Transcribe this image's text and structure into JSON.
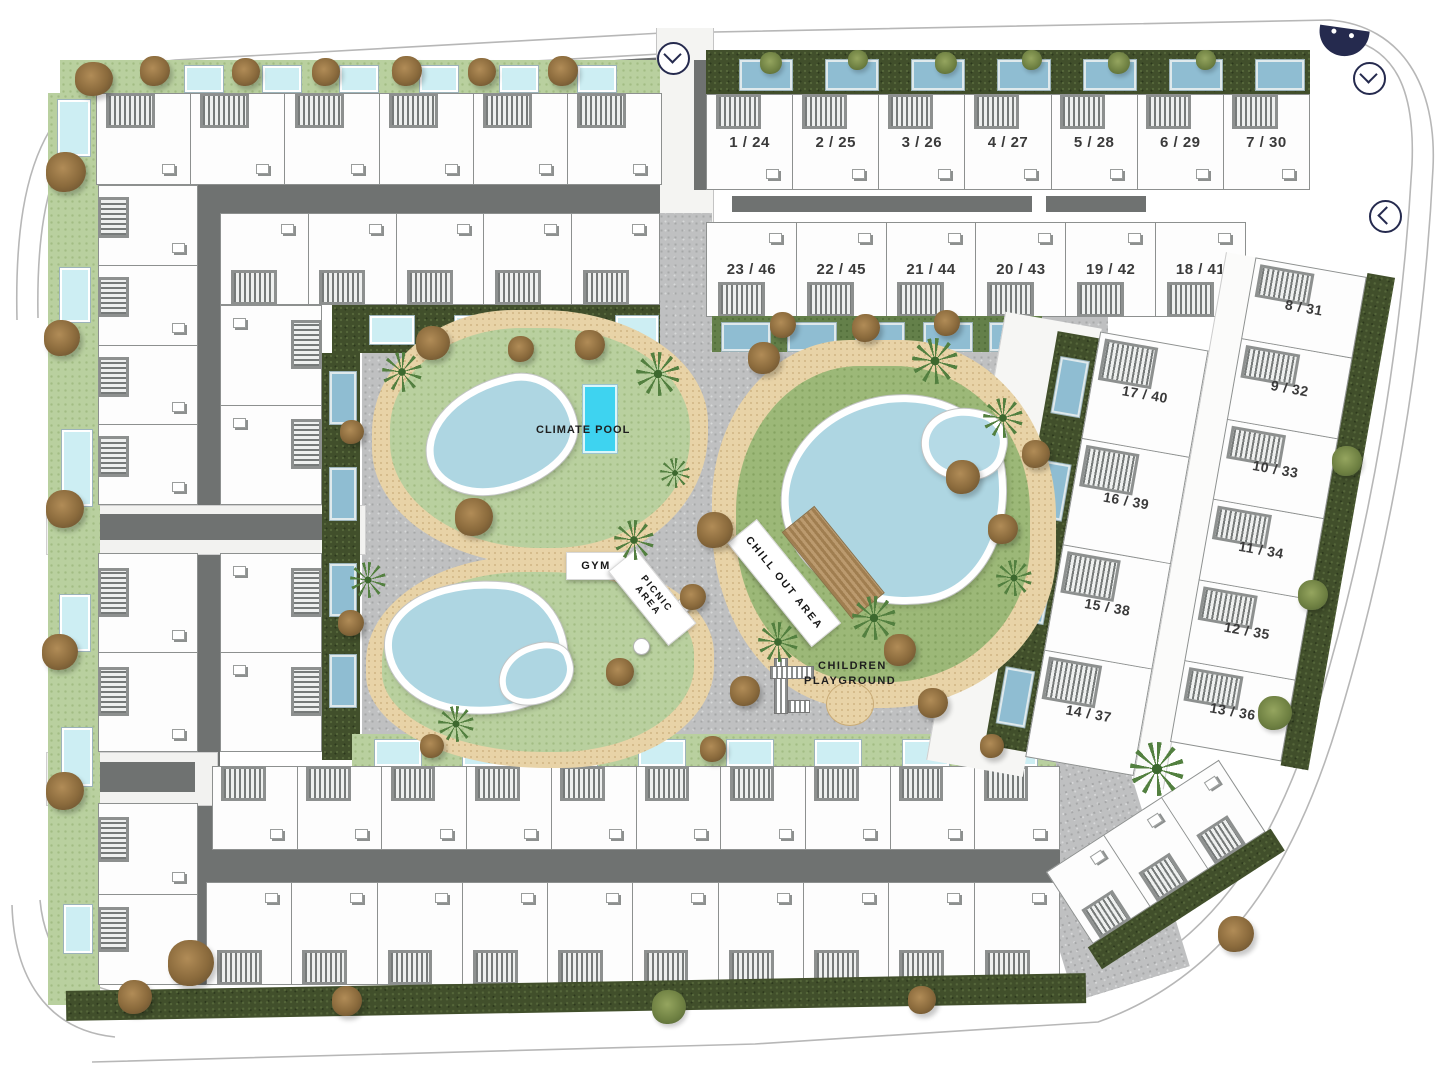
{
  "plan": {
    "title": "residential masterplan",
    "amenities": {
      "climate_pool": "CLIMATE POOL",
      "gym": "GYM",
      "picnic_line1": "PICNIC",
      "picnic_line2": "AREA",
      "chill_out_area": "CHILL OUT AREA",
      "children_line1": "CHILDREN",
      "children_line2": "PLAYGROUND"
    },
    "units": {
      "top_row": [
        "1 / 24",
        "2 / 25",
        "3 / 26",
        "4 / 27",
        "5 / 28",
        "6 / 29",
        "7 / 30"
      ],
      "second_row": [
        "23 / 46",
        "22 / 45",
        "21 / 44",
        "20 / 43",
        "19 / 42",
        "18 / 41"
      ],
      "east_outer_column": [
        "8 / 31",
        "9 / 32",
        "10 / 33",
        "11 / 34",
        "12 / 35",
        "13 / 36"
      ],
      "east_inner_column": [
        "17 / 40",
        "16 / 39",
        "15 / 38",
        "14 / 37"
      ]
    },
    "markers": [
      "entrance-chevron-down",
      "entrance-chevron-down",
      "entrance-chevron-left",
      "spa-half-circle"
    ],
    "colors": {
      "pool_light": "#cdeef3",
      "pool_steel": "#8fbdd2",
      "pool_climate": "#3ed3f0",
      "lawn_light": "#b9d09f",
      "lawn_mid": "#9cb878",
      "hedge_dark": "#414f2b",
      "sand": "#e8d3a7",
      "paving": "#bfc0c1",
      "asphalt": "#6f7271",
      "navy": "#252a4e"
    }
  }
}
